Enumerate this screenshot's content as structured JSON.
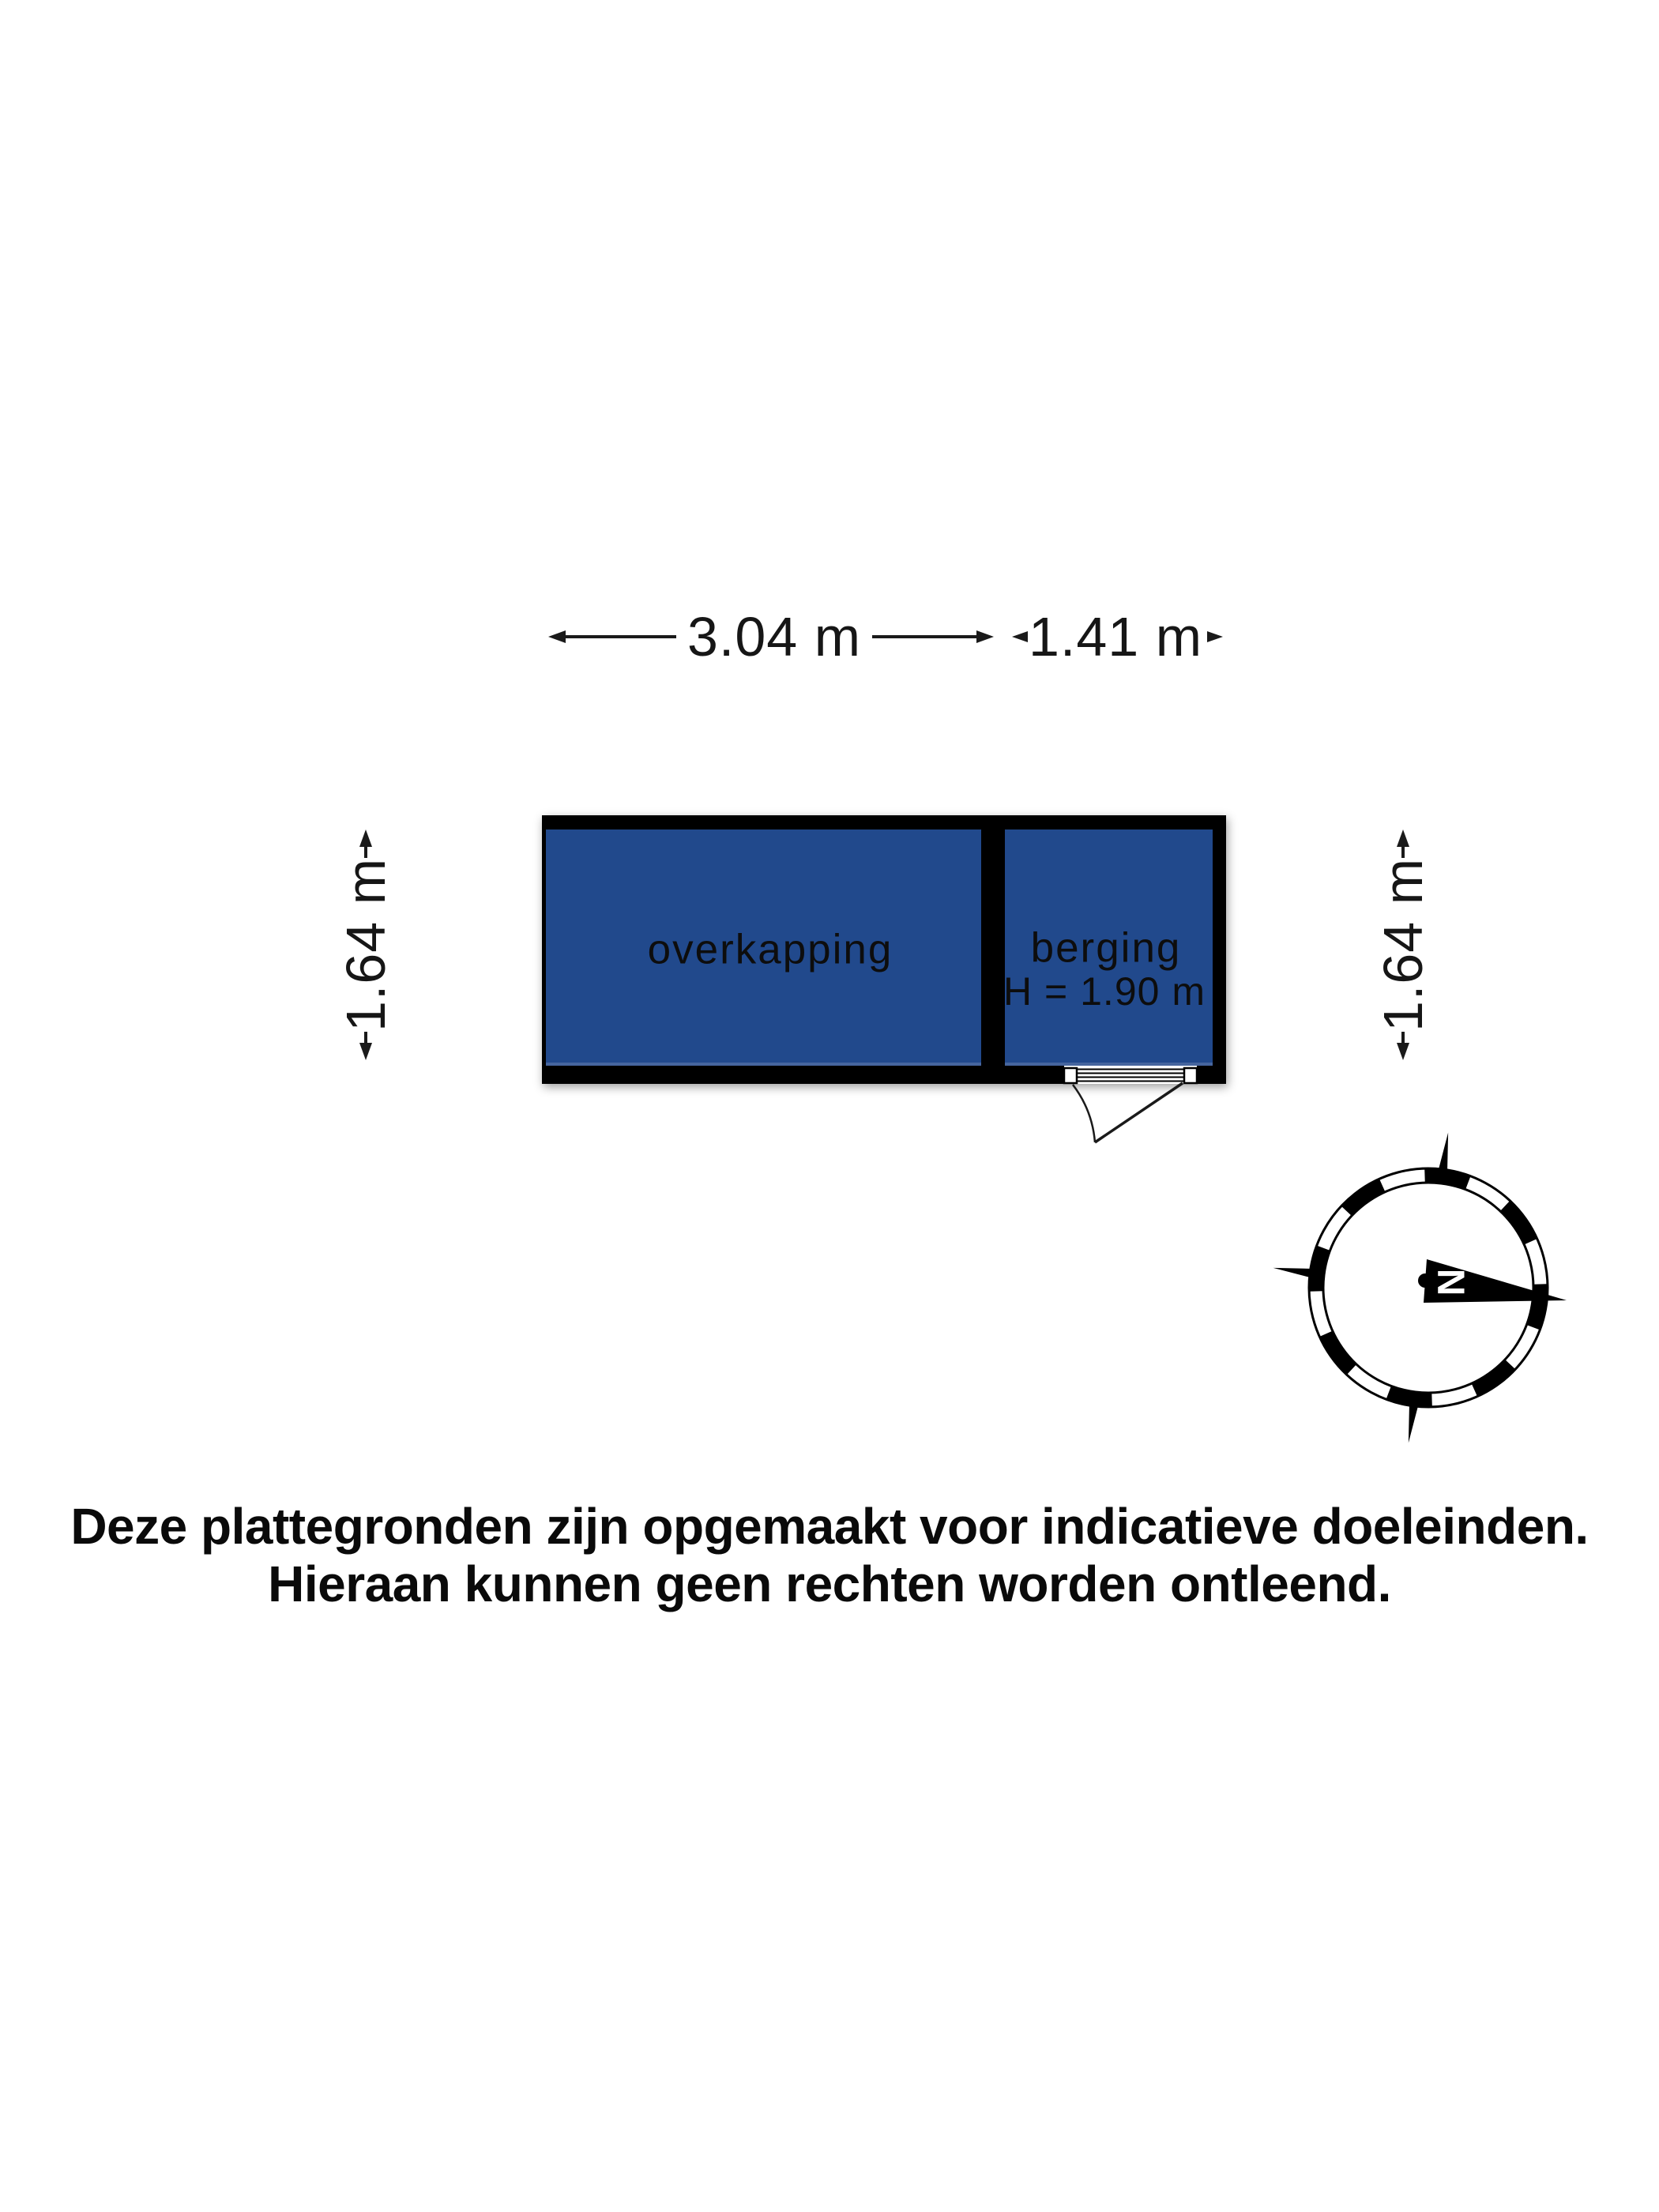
{
  "dimensions": {
    "width_overkapping": "3.04 m",
    "width_berging": "1.41 m",
    "depth_left": "1.64 m",
    "depth_right": "1.64 m"
  },
  "rooms": {
    "overkapping": {
      "label": "overkapping"
    },
    "berging": {
      "label": "berging",
      "height_note": "H = 1.90 m"
    }
  },
  "compass": {
    "north_label": "N"
  },
  "disclaimer": {
    "line1": "Deze plattegronden zijn opgemaakt voor indicatieve doeleinden.",
    "line2": "Hieraan kunnen geen rechten worden ontleend."
  },
  "colors": {
    "room_fill": "#21498C",
    "wall": "#000000",
    "text": "#111111"
  }
}
